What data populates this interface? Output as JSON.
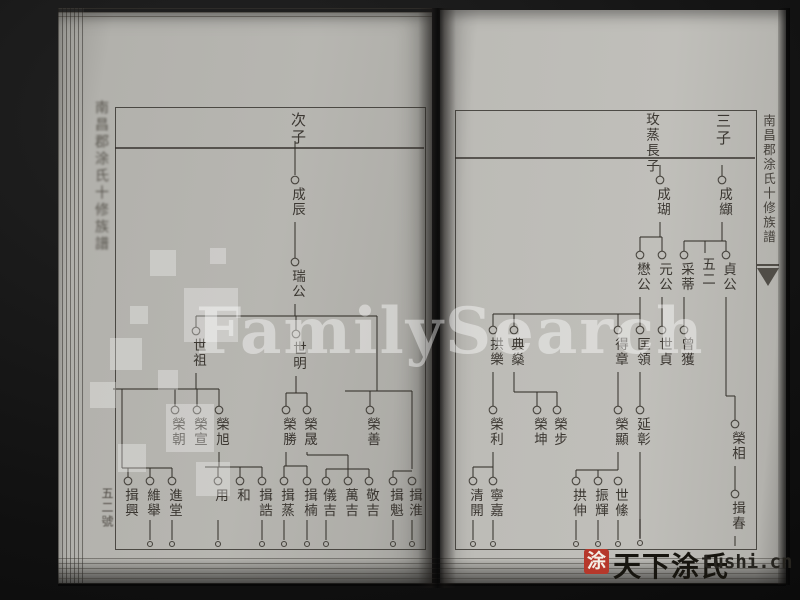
{
  "scene": {
    "background_color": "#101010",
    "page_color": "#b7b6b1",
    "ink_color": "#2e2923",
    "seal_color": "#b6382b"
  },
  "spine": {
    "title": "南昌郡涂氏十修族譜",
    "leaf_number": "五二號"
  },
  "banxin": {
    "title": "南昌郡涂氏十修族譜"
  },
  "watermarks": {
    "center_text": "FamilySearch",
    "logo_squares": [
      [
        150,
        250,
        26
      ],
      [
        184,
        288,
        54
      ],
      [
        130,
        306,
        18
      ],
      [
        110,
        338,
        32
      ],
      [
        158,
        370,
        20
      ],
      [
        90,
        382,
        26
      ],
      [
        166,
        404,
        48
      ],
      [
        118,
        444,
        28
      ],
      [
        210,
        248,
        16
      ],
      [
        196,
        462,
        34
      ]
    ],
    "footer": {
      "seal_char": "涂",
      "brand_text": "天下涂氏",
      "site_text": "tushi.cn"
    }
  },
  "left_page": {
    "header_label": "次子",
    "nodes": [
      {
        "x": 295,
        "y": 180,
        "label": "成辰"
      },
      {
        "x": 295,
        "y": 262,
        "label": "瑞公"
      },
      {
        "x": 196,
        "y": 331,
        "label": "世祖"
      },
      {
        "x": 296,
        "y": 334,
        "label": "世明"
      },
      {
        "x": 175,
        "y": 410,
        "label": "榮朝"
      },
      {
        "x": 197,
        "y": 410,
        "label": "榮宣"
      },
      {
        "x": 219,
        "y": 410,
        "label": "榮旭"
      },
      {
        "x": 286,
        "y": 410,
        "label": "榮勝"
      },
      {
        "x": 307,
        "y": 410,
        "label": "榮晟"
      },
      {
        "x": 370,
        "y": 410,
        "label": "榮善"
      },
      {
        "x": 128,
        "y": 481,
        "label": "揖興"
      },
      {
        "x": 150,
        "y": 481,
        "label": "維舉"
      },
      {
        "x": 172,
        "y": 481,
        "label": "進堂"
      },
      {
        "x": 218,
        "y": 481,
        "label": "用"
      },
      {
        "x": 240,
        "y": 481,
        "label": "和"
      },
      {
        "x": 262,
        "y": 481,
        "label": "揖誥"
      },
      {
        "x": 284,
        "y": 481,
        "label": "揖蒸"
      },
      {
        "x": 307,
        "y": 481,
        "label": "揖楠"
      },
      {
        "x": 326,
        "y": 481,
        "label": "儀吉"
      },
      {
        "x": 348,
        "y": 481,
        "label": "萬吉"
      },
      {
        "x": 369,
        "y": 481,
        "label": "敬吉"
      },
      {
        "x": 393,
        "y": 481,
        "label": "揖魁"
      },
      {
        "x": 412,
        "y": 481,
        "label": "揖淮"
      }
    ],
    "lines": [
      [
        295,
        141,
        295,
        175
      ],
      [
        295,
        222,
        295,
        258
      ],
      [
        295,
        304,
        295,
        316
      ],
      [
        196,
        316,
        377,
        316
      ],
      [
        196,
        316,
        196,
        327
      ],
      [
        296,
        316,
        296,
        330
      ],
      [
        196,
        373,
        196,
        389
      ],
      [
        113,
        389,
        219,
        389
      ],
      [
        122,
        389,
        122,
        468
      ],
      [
        175,
        389,
        175,
        406
      ],
      [
        197,
        389,
        197,
        406
      ],
      [
        219,
        389,
        219,
        406
      ],
      [
        296,
        376,
        296,
        393
      ],
      [
        286,
        393,
        307,
        393
      ],
      [
        286,
        393,
        286,
        406
      ],
      [
        307,
        393,
        307,
        406
      ],
      [
        377,
        316,
        377,
        391
      ],
      [
        345,
        391,
        412,
        391
      ],
      [
        370,
        391,
        370,
        406
      ],
      [
        412,
        391,
        412,
        469
      ],
      [
        122,
        468,
        172,
        468
      ],
      [
        128,
        468,
        128,
        477
      ],
      [
        150,
        468,
        150,
        477
      ],
      [
        172,
        468,
        172,
        477
      ],
      [
        219,
        452,
        219,
        467
      ],
      [
        205,
        467,
        262,
        467
      ],
      [
        218,
        467,
        218,
        477
      ],
      [
        240,
        467,
        240,
        477
      ],
      [
        262,
        467,
        262,
        477
      ],
      [
        286,
        452,
        286,
        466
      ],
      [
        284,
        466,
        307,
        466
      ],
      [
        284,
        466,
        284,
        477
      ],
      [
        307,
        466,
        307,
        477
      ],
      [
        307,
        452,
        307,
        455
      ],
      [
        307,
        455,
        348,
        455
      ],
      [
        348,
        455,
        348,
        469
      ],
      [
        326,
        469,
        369,
        469
      ],
      [
        326,
        469,
        326,
        477
      ],
      [
        348,
        469,
        348,
        477
      ],
      [
        369,
        469,
        369,
        477
      ],
      [
        393,
        471,
        412,
        471
      ],
      [
        393,
        471,
        393,
        477
      ]
    ],
    "dots": [
      {
        "x": 150,
        "y": 544
      },
      {
        "x": 172,
        "y": 544
      },
      {
        "x": 218,
        "y": 544
      },
      {
        "x": 262,
        "y": 544
      },
      {
        "x": 284,
        "y": 544
      },
      {
        "x": 307,
        "y": 544
      },
      {
        "x": 326,
        "y": 544
      },
      {
        "x": 393,
        "y": 544
      },
      {
        "x": 412,
        "y": 544
      }
    ]
  },
  "right_page": {
    "header_primary": "玫蒸長子",
    "header_secondary": "三子",
    "nodes": [
      {
        "x": 660,
        "y": 180,
        "label": "成瑚"
      },
      {
        "x": 722,
        "y": 180,
        "label": "成纈"
      },
      {
        "x": 640,
        "y": 255,
        "label": "懋公"
      },
      {
        "x": 662,
        "y": 255,
        "label": "元公"
      },
      {
        "x": 684,
        "y": 255,
        "label": "采蒂"
      },
      {
        "x": 705,
        "y": 257,
        "label": "五二",
        "circle": false
      },
      {
        "x": 726,
        "y": 255,
        "label": "貞公"
      },
      {
        "x": 493,
        "y": 330,
        "label": "拱樂"
      },
      {
        "x": 514,
        "y": 330,
        "label": "典燊"
      },
      {
        "x": 618,
        "y": 330,
        "label": "得章"
      },
      {
        "x": 640,
        "y": 330,
        "label": "匡領"
      },
      {
        "x": 662,
        "y": 330,
        "label": "世貞"
      },
      {
        "x": 684,
        "y": 330,
        "label": "曾獲"
      },
      {
        "x": 493,
        "y": 410,
        "label": "榮利"
      },
      {
        "x": 537,
        "y": 410,
        "label": "榮坤"
      },
      {
        "x": 557,
        "y": 410,
        "label": "榮步"
      },
      {
        "x": 618,
        "y": 410,
        "label": "榮顯"
      },
      {
        "x": 640,
        "y": 410,
        "label": "延彰"
      },
      {
        "x": 735,
        "y": 424,
        "label": "榮相"
      },
      {
        "x": 473,
        "y": 481,
        "label": "清開"
      },
      {
        "x": 493,
        "y": 481,
        "label": "寧嘉"
      },
      {
        "x": 576,
        "y": 481,
        "label": "拱伸"
      },
      {
        "x": 598,
        "y": 481,
        "label": "振輝"
      },
      {
        "x": 618,
        "y": 481,
        "label": "世絛"
      },
      {
        "x": 735,
        "y": 494,
        "label": "揖春"
      }
    ],
    "lines": [
      [
        660,
        165,
        660,
        176
      ],
      [
        660,
        222,
        660,
        237
      ],
      [
        640,
        237,
        662,
        237
      ],
      [
        640,
        237,
        640,
        251
      ],
      [
        662,
        237,
        662,
        251
      ],
      [
        722,
        165,
        722,
        176
      ],
      [
        722,
        222,
        722,
        241
      ],
      [
        684,
        241,
        726,
        241
      ],
      [
        684,
        241,
        684,
        251
      ],
      [
        705,
        241,
        705,
        253
      ],
      [
        726,
        241,
        726,
        251
      ],
      [
        640,
        297,
        640,
        314
      ],
      [
        493,
        314,
        640,
        314
      ],
      [
        493,
        314,
        493,
        326
      ],
      [
        514,
        314,
        514,
        326
      ],
      [
        618,
        314,
        618,
        326
      ],
      [
        640,
        314,
        640,
        326
      ],
      [
        662,
        297,
        662,
        326
      ],
      [
        684,
        297,
        684,
        326
      ],
      [
        493,
        372,
        493,
        406
      ],
      [
        514,
        372,
        514,
        392
      ],
      [
        514,
        392,
        557,
        392
      ],
      [
        537,
        392,
        537,
        406
      ],
      [
        557,
        392,
        557,
        406
      ],
      [
        618,
        372,
        618,
        406
      ],
      [
        640,
        372,
        640,
        406
      ],
      [
        493,
        452,
        493,
        467
      ],
      [
        473,
        467,
        493,
        467
      ],
      [
        473,
        467,
        473,
        477
      ],
      [
        493,
        467,
        493,
        477
      ],
      [
        618,
        452,
        618,
        470
      ],
      [
        576,
        470,
        618,
        470
      ],
      [
        576,
        470,
        576,
        477
      ],
      [
        598,
        470,
        598,
        477
      ],
      [
        640,
        452,
        640,
        538
      ],
      [
        726,
        297,
        726,
        396
      ],
      [
        726,
        396,
        735,
        396
      ],
      [
        735,
        396,
        735,
        420
      ],
      [
        735,
        466,
        735,
        490
      ],
      [
        735,
        536,
        735,
        546
      ]
    ],
    "dots": [
      {
        "x": 473,
        "y": 544
      },
      {
        "x": 493,
        "y": 544
      },
      {
        "x": 576,
        "y": 544
      },
      {
        "x": 598,
        "y": 544
      },
      {
        "x": 618,
        "y": 544
      },
      {
        "x": 640,
        "y": 543
      }
    ]
  }
}
